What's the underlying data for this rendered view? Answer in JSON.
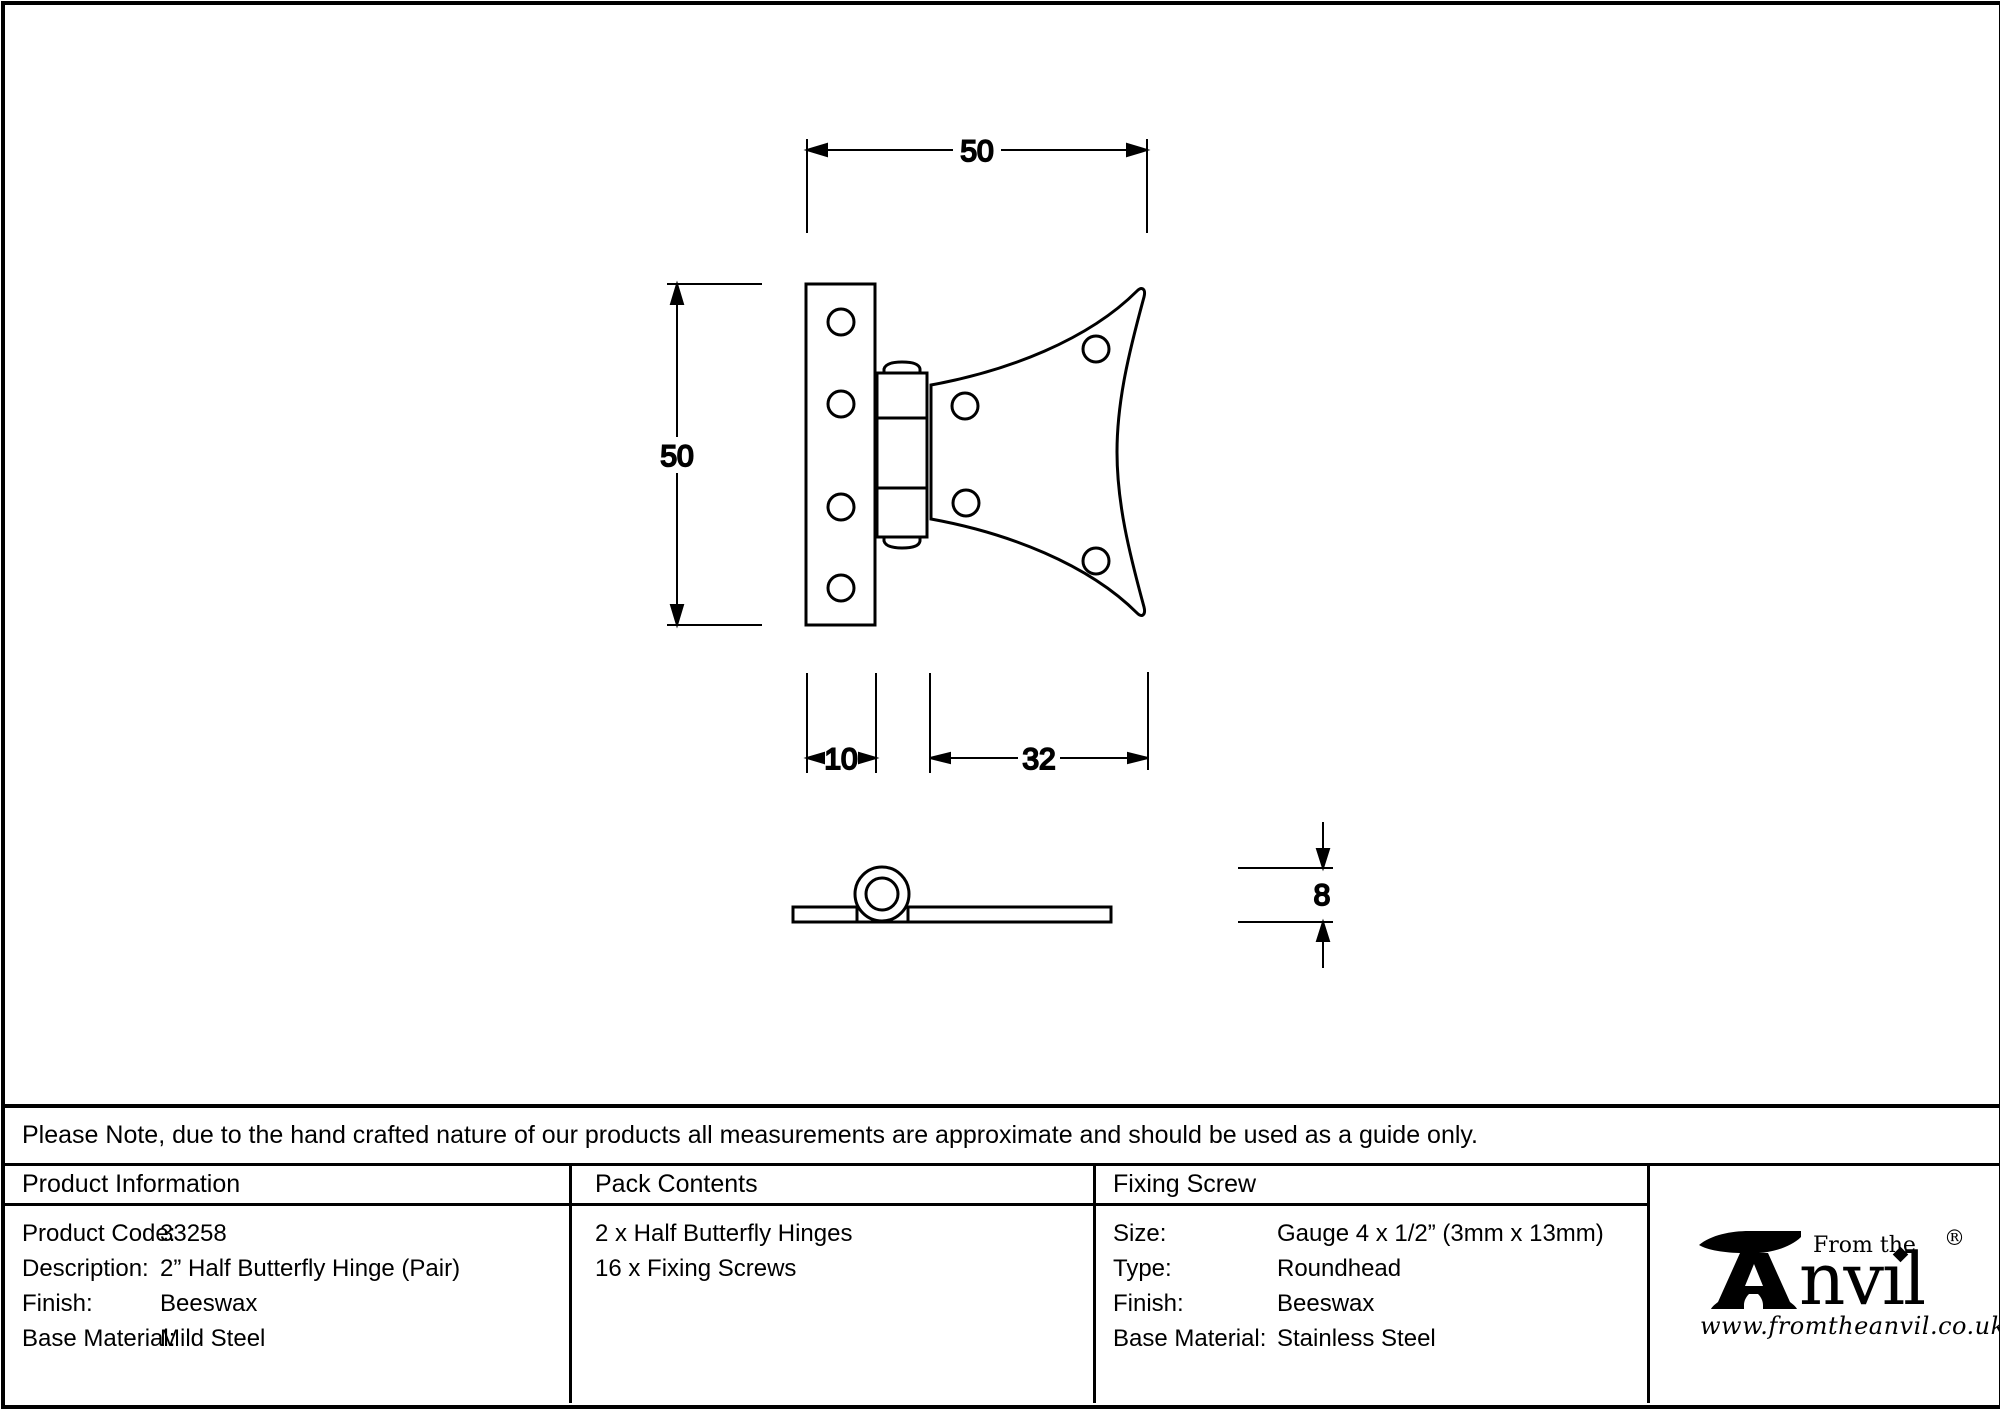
{
  "note": "Please Note, due to the hand crafted nature of our products all measurements are approximate and should be used as a guide only.",
  "drawing": {
    "dim_width": "50",
    "dim_height": "50",
    "dim_plate_width": "10",
    "dim_wing_width": "32",
    "dim_thickness": "8"
  },
  "table": {
    "product_information": {
      "header": "Product Information",
      "rows": [
        {
          "label": "Product Code:",
          "value": "33258"
        },
        {
          "label": "Description:",
          "value": "2” Half Butterfly Hinge (Pair)"
        },
        {
          "label": "Finish:",
          "value": "Beeswax"
        },
        {
          "label": "Base Material:",
          "value": "Mild Steel"
        }
      ]
    },
    "pack_contents": {
      "header": "Pack Contents",
      "items": [
        "2 x Half Butterfly Hinges",
        "16 x Fixing Screws"
      ]
    },
    "fixing_screw": {
      "header": "Fixing Screw",
      "rows": [
        {
          "label": "Size:",
          "value": "Gauge 4 x 1/2” (3mm x 13mm)"
        },
        {
          "label": "Type:",
          "value": "Roundhead"
        },
        {
          "label": "Finish:",
          "value": "Beeswax"
        },
        {
          "label": "Base Material:",
          "value": "Stainless Steel"
        }
      ]
    }
  },
  "logo": {
    "tagline": "From the",
    "brand_suffix": "nvıl",
    "registered": "®",
    "url": "www.fromtheanvil.co.uk"
  }
}
